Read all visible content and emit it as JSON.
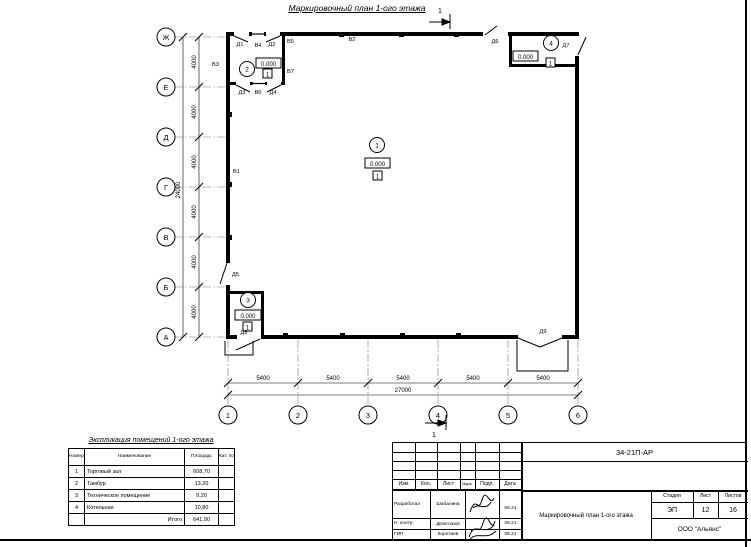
{
  "drawing": {
    "title": "Маркировочный план 1-ого этажа",
    "section_cut_top": "1",
    "section_cut_bottom": "1"
  },
  "axes": {
    "vertical": [
      "Ж",
      "Е",
      "Д",
      "Г",
      "В",
      "Б",
      "А"
    ],
    "horizontal": [
      "1",
      "2",
      "3",
      "4",
      "5",
      "6"
    ]
  },
  "dimensions": {
    "left_segments": [
      "4000",
      "4000",
      "4000",
      "4000",
      "4000",
      "4000"
    ],
    "left_total": "24000",
    "bottom_segments": [
      "5400",
      "5400",
      "5400",
      "5400",
      "5400"
    ],
    "bottom_total": "27000"
  },
  "rooms": [
    {
      "number": "1",
      "elevation": "0.000",
      "floor_type": "1"
    },
    {
      "number": "2",
      "elevation": "0.000",
      "floor_type": "1"
    },
    {
      "number": "3",
      "elevation": "0.000",
      "floor_type": "1"
    },
    {
      "number": "4",
      "elevation": "0.000",
      "floor_type": "1"
    }
  ],
  "openings": {
    "doors": [
      "Д1",
      "Д2",
      "Д3",
      "Д4",
      "Д5",
      "Д6",
      "Д7",
      "Д8",
      "Д9"
    ],
    "windows": [
      "В1",
      "В2",
      "В3",
      "В4",
      "В5",
      "В6",
      "В7"
    ]
  },
  "explication": {
    "title": "Экспликация помещений 1-ого этажа",
    "headers": [
      "Номер помещ.",
      "Наименование",
      "Площадь",
      "Кат. пом."
    ],
    "rows": [
      {
        "num": "1",
        "name": "Торговый зал",
        "area": "608,70"
      },
      {
        "num": "2",
        "name": "Тамбур",
        "area": "13,20"
      },
      {
        "num": "3",
        "name": "Техническое помещение",
        "area": "9,20"
      },
      {
        "num": "4",
        "name": "Котельная",
        "area": "10,80"
      }
    ],
    "total_label": "Итого",
    "total_area": "641,90"
  },
  "stamp": {
    "doc_number": "34-21П-АР",
    "columns": [
      "Изм.",
      "Кол.",
      "Лист",
      "№док.",
      "Подп.",
      "Дата"
    ],
    "signature_rows": [
      {
        "role": "Разработал",
        "name": "Шабалина",
        "date": "08.21"
      },
      {
        "role": "Н. контр.",
        "name": "Двоеглазов",
        "date": "08.21"
      },
      {
        "role": "ГИП",
        "name": "Коротаев",
        "date": "08.21"
      }
    ],
    "stage_label": "Стадия",
    "sheet_label": "Лист",
    "sheets_label": "Листов",
    "stage": "ЭП",
    "sheet": "12",
    "sheets": "16",
    "doc_title": "Маркировочный план 1-ого этажа",
    "company": "ООО \"Альянс\""
  }
}
